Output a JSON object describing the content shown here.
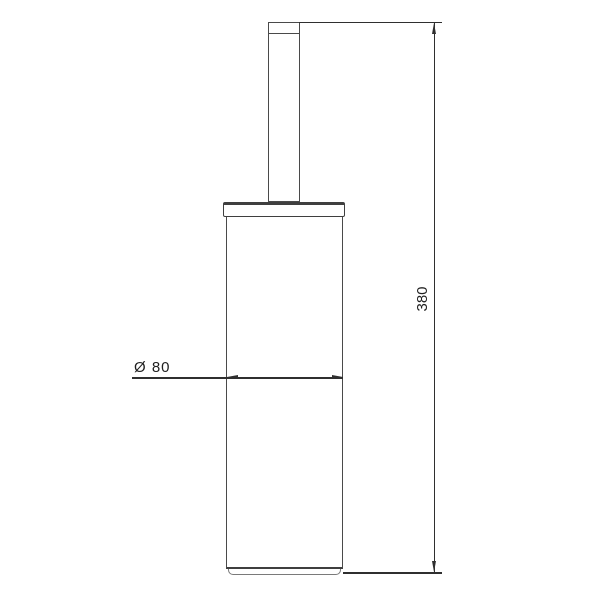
{
  "drawing": {
    "object": "cylindrical-canister-with-handle",
    "labels": {
      "diameter": "Ø 80",
      "height": "380"
    },
    "colors": {
      "outline": "#4a4a4a",
      "dimension_line": "#2f2f2f",
      "text": "#1f1f1f",
      "background": "#ffffff"
    }
  }
}
